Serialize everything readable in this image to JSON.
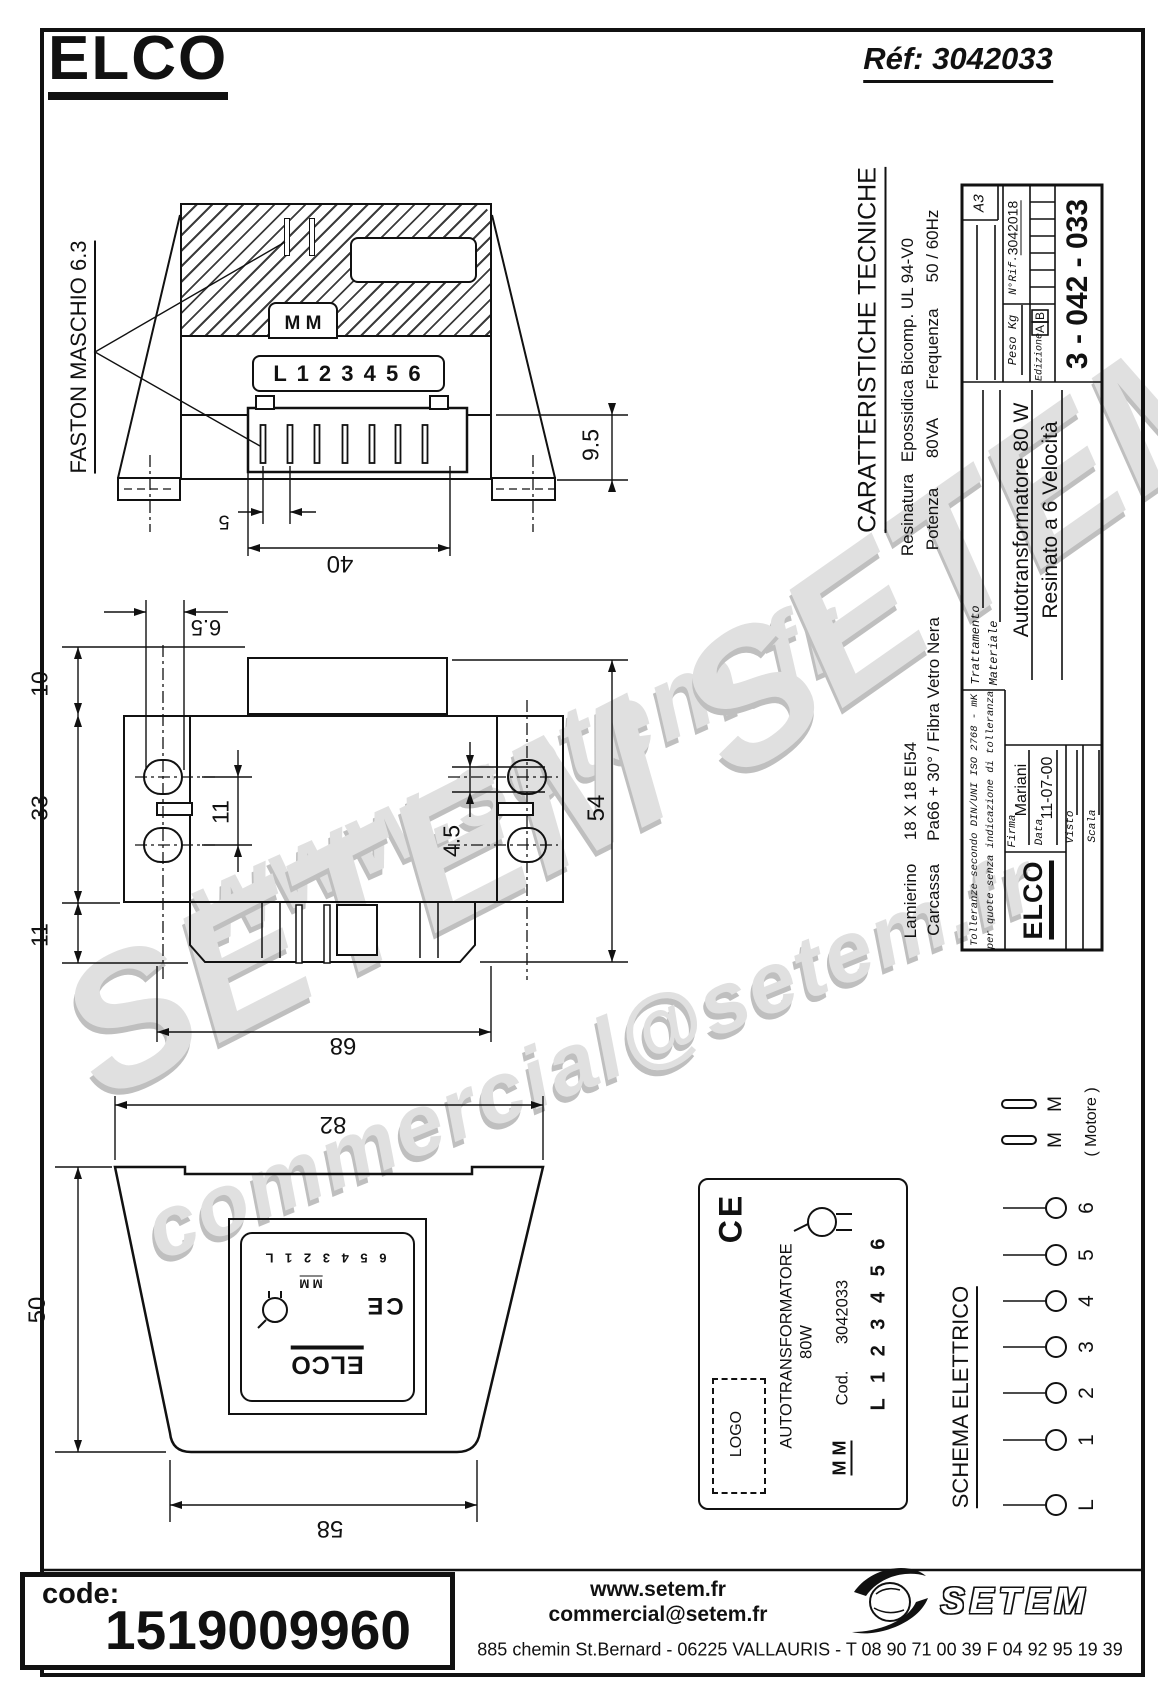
{
  "header": {
    "logo": "ELCO",
    "ref": "Réf: 3042033"
  },
  "callout": {
    "faston": "FASTON MASCHIO 6.3"
  },
  "front_view": {
    "mm": "M  M",
    "terminals": "L 1 2 3 4 5 6",
    "dim_9_5": "9.5",
    "dim_5": "5",
    "dim_40": "40"
  },
  "top_view": {
    "dim_6_5": "6.5",
    "dim_10": "10",
    "dim_33": "33",
    "dim_11_left": "11",
    "dim_11_holes": "11",
    "dim_4_5": "4.5",
    "dim_54": "54",
    "dim_68": "68"
  },
  "side_view": {
    "dim_82": "82",
    "dim_50": "50",
    "dim_58": "58",
    "label": {
      "terminals": "6 5 4 3 2 1 L",
      "mm": "M M",
      "ce": "CE",
      "elco": "ELCO"
    }
  },
  "label_detail": {
    "ce": "CE",
    "title": "AUTOTRANSFORMATORE",
    "power": "80W",
    "cod_label": "Cod.",
    "cod_value": "3042033",
    "terminals": "L 1 2 3 4 5 6",
    "logo_placeholder": "LOGO",
    "mm": "M M"
  },
  "schema": {
    "title": "SCHEMA ELETTRICO",
    "terminals": [
      "6",
      "5",
      "4",
      "3",
      "2",
      "1",
      "L"
    ],
    "m1": "M",
    "m2": "M",
    "motor_note": "( Motore )"
  },
  "tech": {
    "title": "CARATTERISTICHE TECNICHE",
    "resinatura_label": "Resinatura",
    "resinatura_value": "Epossidica Bicomp. UL 94-V0",
    "potenza_label": "Potenza",
    "potenza_value": "80VA",
    "frequenza_label": "Frequenza",
    "frequenza_value": "50 / 60Hz",
    "lamierino_label": "Lamierino",
    "lamierino_value": "18 X 18 EI54",
    "carcassa_label": "Carcassa",
    "carcassa_value": "Pa66 + 30° / Fibra Vetro Nera"
  },
  "title_block": {
    "format": "A3",
    "nrif_label": "N°Rif.",
    "nrif_value": "3042018",
    "peso": "Peso Kg",
    "edizione": "Edizione",
    "rev_a": "A",
    "rev_b": "B",
    "code": "3 - 042 - 033",
    "trattamento": "Trattamento",
    "materiale": "Materiale",
    "tol1": "Tolleranze secondo DIN/UNI ISO 2768 - mK",
    "tol2": "per quote senza indicazione di tolleranza",
    "firma_label": "Firma",
    "firma_value": "Mariani",
    "data_label": "Data",
    "data_value": "11-07-00",
    "visto": "Visto",
    "scala": "Scala",
    "elco": "ELCO",
    "desc1": "Autotransformatore  80 W",
    "desc2": "Resinato  a  6 Velocità"
  },
  "watermarks": {
    "wm1": "www.setem.fr",
    "wm2": "SETEM",
    "wm3": "SETEM",
    "wm4": "commercial@setem.fr"
  },
  "footer": {
    "code_label": "code:",
    "code_value": "1519009960",
    "web": "www.setem.fr",
    "email": "commercial@setem.fr",
    "address": "885 chemin St.Bernard  -  06225 VALLAURIS  -  T 08 90 71 00 39   F 04 92 95 19 39",
    "setem": "SETEM"
  }
}
